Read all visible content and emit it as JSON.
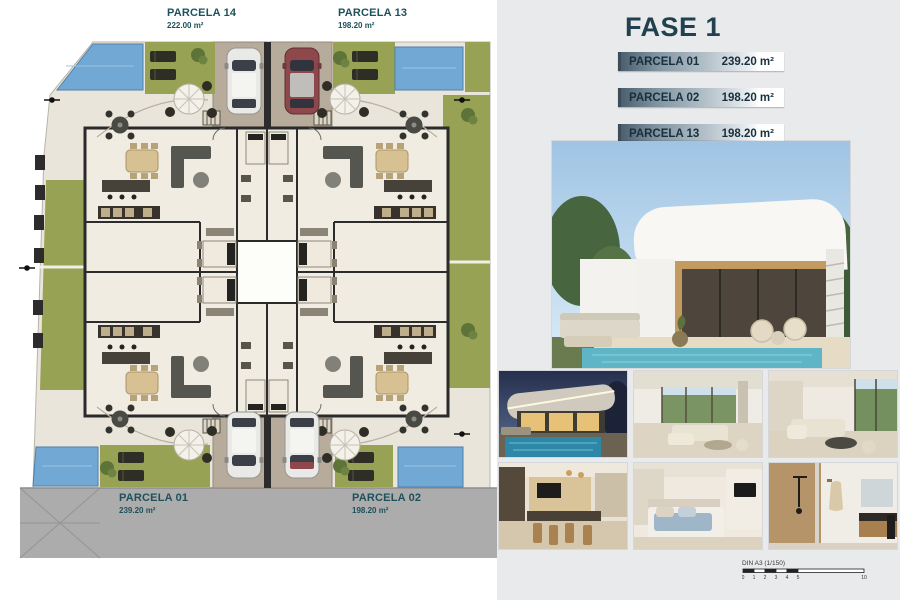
{
  "plan": {
    "parcels": [
      {
        "name": "PARCELA 14",
        "area": "222.00 m²"
      },
      {
        "name": "PARCELA 13",
        "area": "198.20 m²"
      },
      {
        "name": "PARCELA 01",
        "area": "239.20 m²"
      },
      {
        "name": "PARCELA 02",
        "area": "198.20 m²"
      }
    ]
  },
  "phase_panel": {
    "title": "FASE 1",
    "rows": [
      {
        "label": "PARCELA 01",
        "value": "239.20 m²"
      },
      {
        "label": "PARCELA 02",
        "value": "198.20 m²"
      },
      {
        "label": "PARCELA 13",
        "value": "198.20 m²"
      },
      {
        "label": "PARCELA 14",
        "value": "222.00 m²"
      }
    ]
  },
  "scale_bar": {
    "label": "DIN A3 (1/150)",
    "ticks": [
      "0",
      "1",
      "2",
      "3",
      "4",
      "5",
      "10"
    ]
  },
  "colors": {
    "accent_teal": "#1d515c",
    "panel_bg": "#e8eaec",
    "pool_blue": "#72a9d4",
    "garden_green": "#97a254",
    "road_gray": "#acacac"
  }
}
